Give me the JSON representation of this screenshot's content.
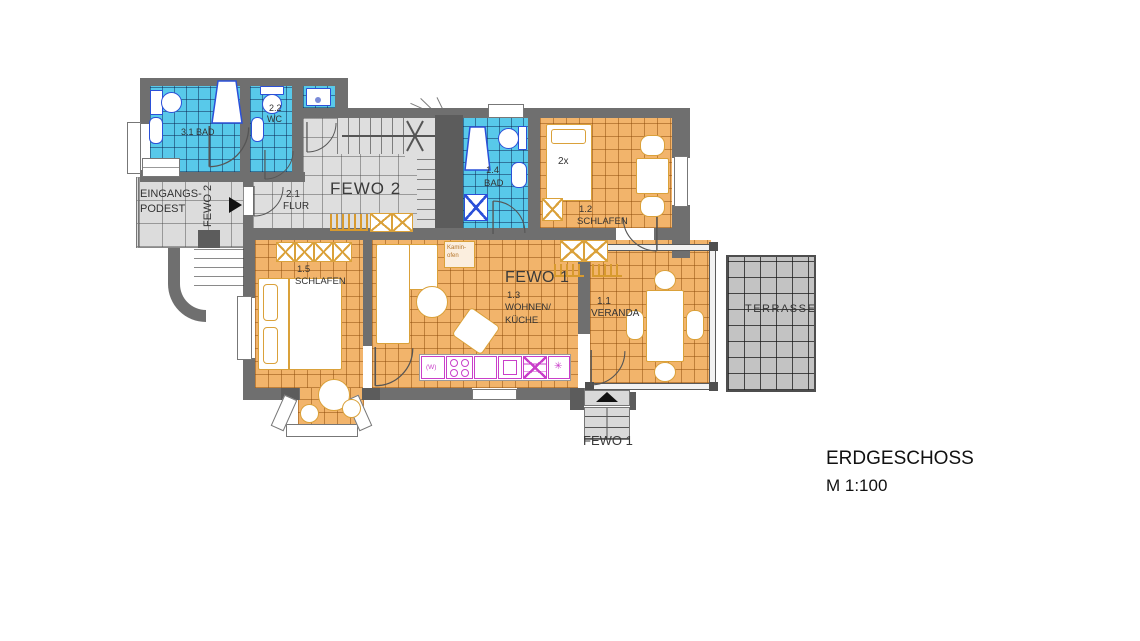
{
  "title": {
    "heading": "ERDGESCHOSS",
    "scale": "M 1:100"
  },
  "apartments": {
    "fewo1": "FEWO 1",
    "fewo2": "FEWO 2",
    "fewo1_entrance": "FEWO 1",
    "fewo2_entrance": "FEWO 2"
  },
  "rooms": {
    "bad31": "3.1 BAD",
    "wc22_no": "2.2",
    "wc22": "WC",
    "flur21_no": "2.1",
    "flur21": "FLUR",
    "bad14_no": "1.4",
    "bad14": "BAD",
    "schlafen12_no": "1.2",
    "schlafen12": "SCHLAFEN",
    "schlafen15_no": "1.5",
    "schlafen15": "SCHLAFEN",
    "wohnen13_no": "1.3",
    "wohnen13a": "WOHNEN/",
    "wohnen13b": "KÜCHE",
    "veranda11_no": "1.1",
    "veranda11": "VERANDA",
    "terrasse": "TERRASSE",
    "eingang1": "EINGANGS-",
    "eingang2": "PODEST"
  },
  "annotations": {
    "beds": "2x",
    "kamin1": "Kamin-",
    "kamin2": "ofen",
    "washer": "(W)",
    "star": "✳"
  },
  "colors": {
    "wall": "#6f6f6f",
    "tile_blue": "#58c9ea",
    "tile_orange": "#f2b46b",
    "tile_gray": "#dedede",
    "terrace": "#c3c3c3",
    "furniture_outline": "#daa13a",
    "fixture_outline": "#2b50d8",
    "kitchen_outline": "#c93fc9"
  }
}
